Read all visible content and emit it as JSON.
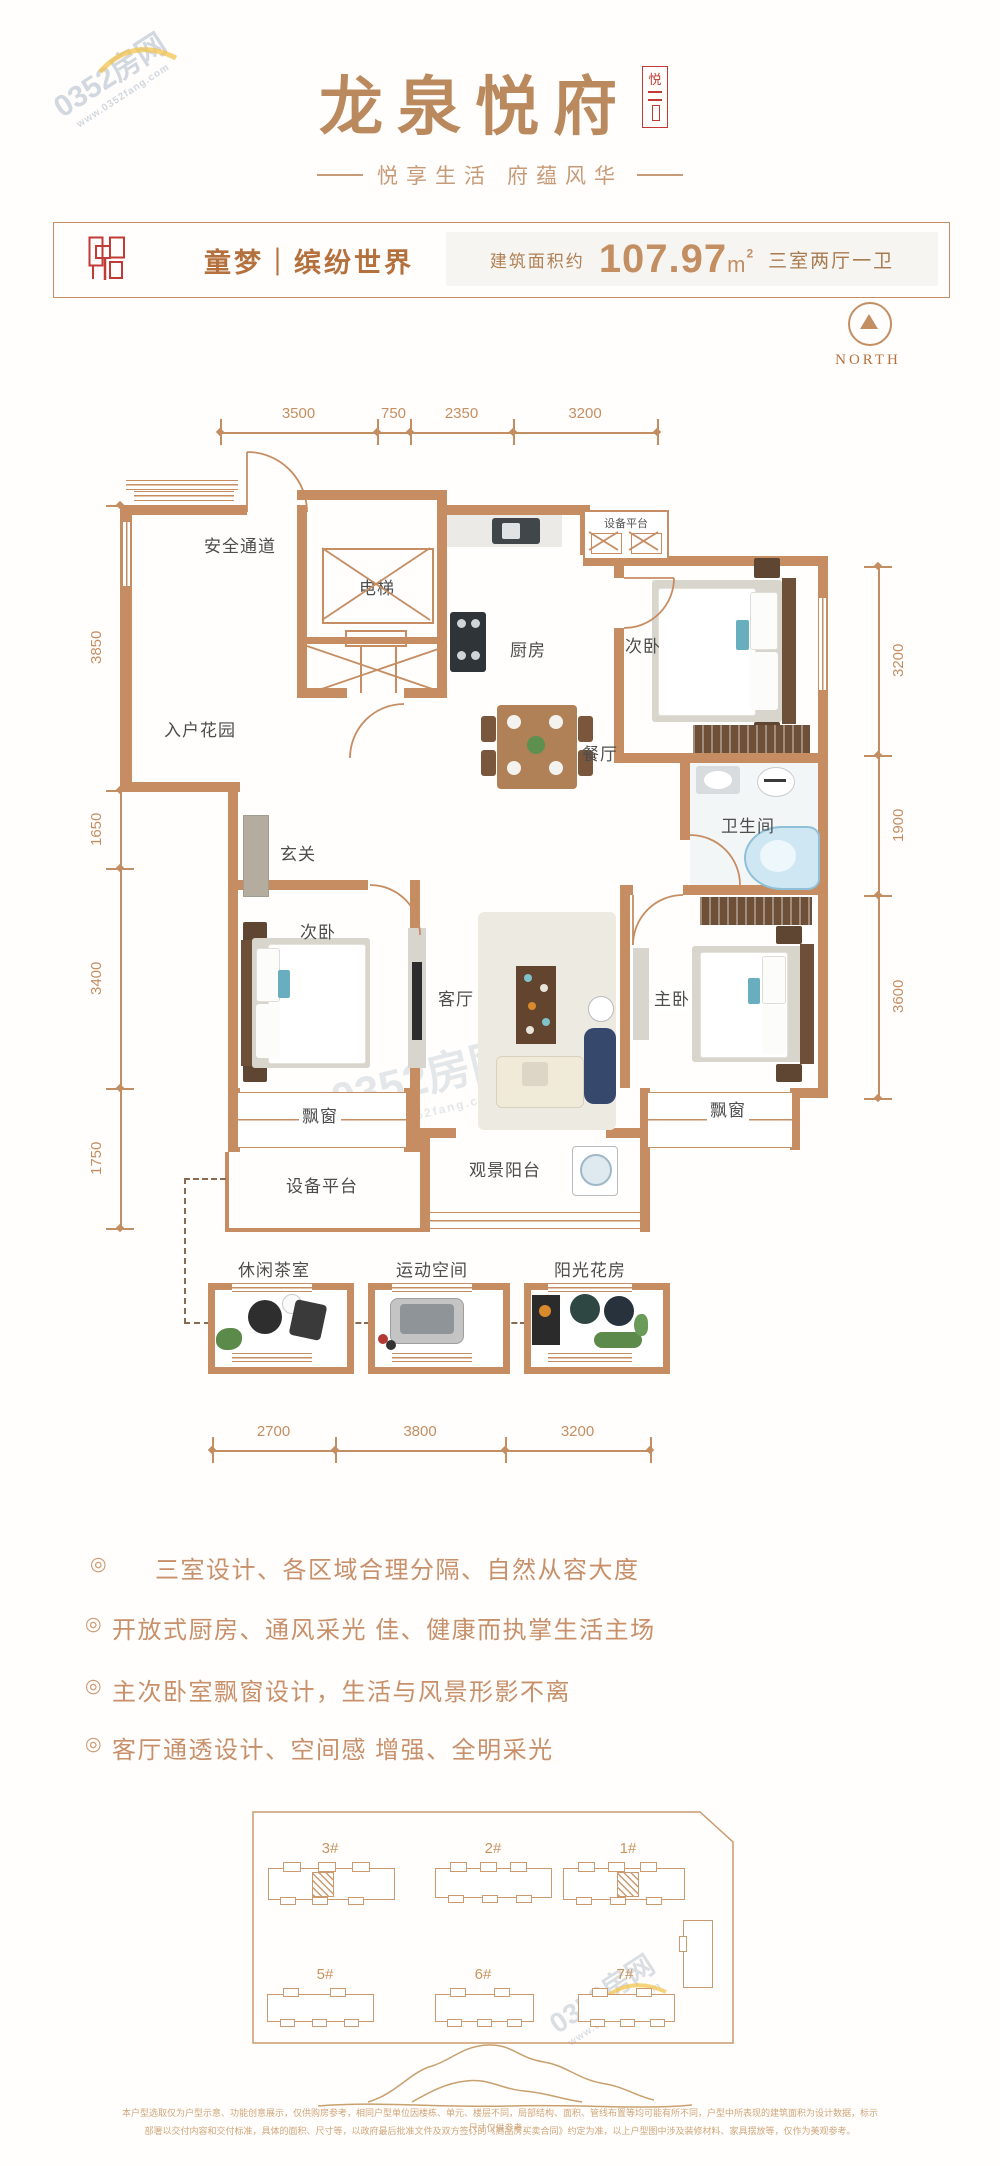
{
  "watermark": {
    "brand": "0352房网",
    "site": "www.0352fang.com"
  },
  "brand": {
    "title": "龙泉悦府",
    "seal_char": "悦",
    "subtitle_left": "悦享生活",
    "subtitle_right": "府蕴风华"
  },
  "header": {
    "tag": "童梦｜缤纷世界",
    "area_prefix": "建筑面积约",
    "area_value": "107.97",
    "area_unit_base": "m",
    "area_unit_sup": "2",
    "layout": "三室两厅一卫"
  },
  "north": {
    "label": "NORTH"
  },
  "plan": {
    "dims_top": [
      "3500",
      "750",
      "2350",
      "3200"
    ],
    "dims_left": [
      "3850",
      "1650",
      "3400",
      "1750"
    ],
    "dims_right": [
      "3200",
      "1900",
      "3600"
    ],
    "dims_bottom": [
      "2700",
      "3800",
      "3200"
    ],
    "rooms": {
      "safety": "安全通道",
      "elevator": "电梯",
      "kitchen": "厨房",
      "bedroom_top": "次卧",
      "equip_top": "设备平台",
      "garden": "入户花园",
      "dining": "餐厅",
      "bath": "卫生间",
      "foyer": "玄关",
      "bedroom_left": "次卧",
      "living": "客厅",
      "master": "主卧",
      "bay_left": "飘窗",
      "bay_right": "飘窗",
      "equip_bottom": "设备平台",
      "balcony": "观景阳台"
    },
    "annex": {
      "tea": "休闲茶室",
      "sport": "运动空间",
      "sun": "阳光花房"
    }
  },
  "features": {
    "marker": "◎",
    "items": [
      "三室设计、各区域合理分隔、自然从容大度",
      "开放式厨房、通风采光 佳、健康而执掌生活主场",
      "主次卧室飘窗设计，生活与风景形影不离",
      "客厅通透设计、空间感 增强、全明采光"
    ]
  },
  "siteplan": {
    "buildings": [
      "3#",
      "2#",
      "1#",
      "5#",
      "6#",
      "7#"
    ]
  },
  "disclaimer": [
    "本户型选取仅为户型示意、功能创意展示，仅供购房参考，相同户型单位因楼栋、单元、楼层不同，局部结构、面积、管线布置等均可能有所不同，户型中所表现的建筑面积为设计数据，标示尺寸仅供参考，",
    "部署以交付内容和交付标准，具体的面积、尺寸等，以政府最后批准文件及双方签订的《商品房买卖合同》约定为准，以上户型图中涉及装修材料、家具摆放等，仅作为美观参考。"
  ]
}
